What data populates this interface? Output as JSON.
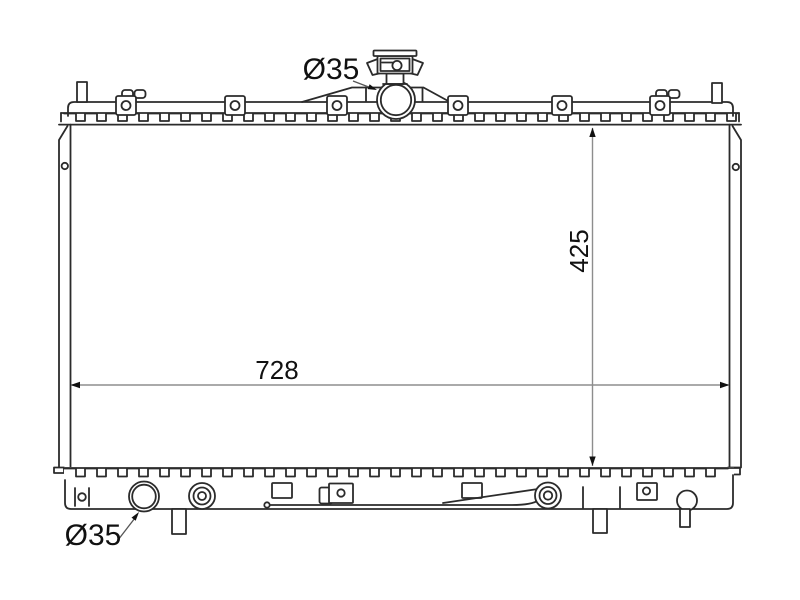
{
  "page": {
    "background": "#ffffff"
  },
  "drawing": {
    "title": "radiator-technical-drawing",
    "line_color": "#2b2b2b",
    "dim_line_color": "#8d8d8d",
    "text_color": "#111111",
    "labels": {
      "top_port_diameter": "Ø35",
      "core_height": "425",
      "core_width": "728",
      "bottom_port_diameter": "Ø35"
    }
  }
}
